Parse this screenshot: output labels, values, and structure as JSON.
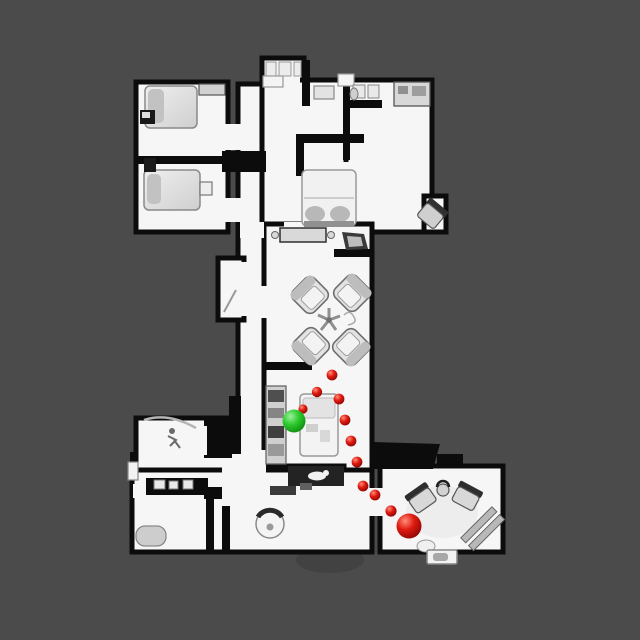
{
  "scene": {
    "kind": "top-down floor plan navigation map",
    "background_color": "#4b4b4b",
    "floor_color": "#f6f6f6",
    "wall_color": "#0c0c0c",
    "furniture_color": "#d8d8d8"
  },
  "navigation": {
    "start_marker": {
      "label": "start-position",
      "color": "#2bc62b",
      "x": 294,
      "y": 421,
      "r": 11.5
    },
    "goal_marker": {
      "label": "goal-position",
      "color": "#d01010",
      "x": 409,
      "y": 526,
      "r": 12.5
    },
    "waypoint_color": "#d01010",
    "waypoints": [
      {
        "x": 332,
        "y": 375,
        "r": 5.4
      },
      {
        "x": 317,
        "y": 392,
        "r": 5.2
      },
      {
        "x": 339,
        "y": 399,
        "r": 5.4
      },
      {
        "x": 303,
        "y": 409,
        "r": 4.6
      },
      {
        "x": 345,
        "y": 420,
        "r": 5.4
      },
      {
        "x": 351,
        "y": 441,
        "r": 5.4
      },
      {
        "x": 357,
        "y": 462,
        "r": 5.4
      },
      {
        "x": 363,
        "y": 486,
        "r": 5.4
      },
      {
        "x": 375,
        "y": 495,
        "r": 5.4
      },
      {
        "x": 391,
        "y": 511,
        "r": 5.6
      }
    ]
  }
}
